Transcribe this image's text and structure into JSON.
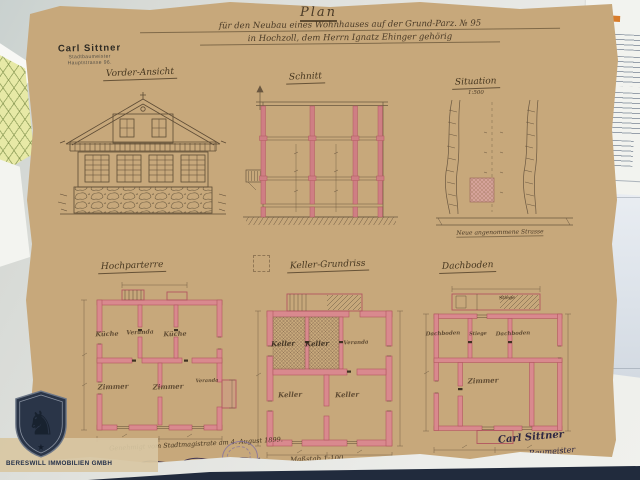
{
  "plan": {
    "title": "Plan",
    "subtitle1": "für den Neubau eines Wohnhauses auf der Grund-Parz. № 95",
    "subtitle2": "in Hochzoll, dem Herrn Ignatz Ehinger gehörig",
    "stamp": {
      "name": "Carl Sittner",
      "role": "Stadtbaumeister",
      "address": "Hauptstrasse 96."
    },
    "captions": {
      "elevation": "Vorder-Ansicht",
      "section": "Schnitt",
      "situation": "Situation",
      "situation_scale": "1:500",
      "ground_floor": "Hochparterre",
      "cellar": "Keller-Grundriss",
      "attic": "Dachboden"
    },
    "rooms": {
      "hochparterre": [
        "Küche",
        "Veranda",
        "Küche",
        "Zimmer",
        "Zimmer"
      ],
      "hochparterre_right": "Veranda",
      "keller": [
        "Keller",
        "Keller",
        "Veranda",
        "Keller",
        "Keller"
      ],
      "dachboden": [
        "Dachboden",
        "Stiege",
        "Dachboden",
        "Zimmer"
      ],
      "dachboden_top": "Stiege"
    },
    "situation_road": "Neue angenommene Strasse",
    "approval": "Genehmigt vom Stadtmagistrate am 4. August 1899.",
    "scale_note": "Maßstab 1:100",
    "signature_name": "Carl Sittner",
    "signature_role": "Baumeister"
  },
  "watermark": {
    "company": "BERESWILL IMMOBILIEN GMBH",
    "horse_glyph": "♞",
    "star_glyph": "★"
  },
  "colors": {
    "plan_paper": "#c9ad80",
    "wall_red": "#c9616b",
    "ink_sepia": "#5a4936",
    "logo_navy": "#24304a",
    "seal_purple": "#8d7fae"
  }
}
